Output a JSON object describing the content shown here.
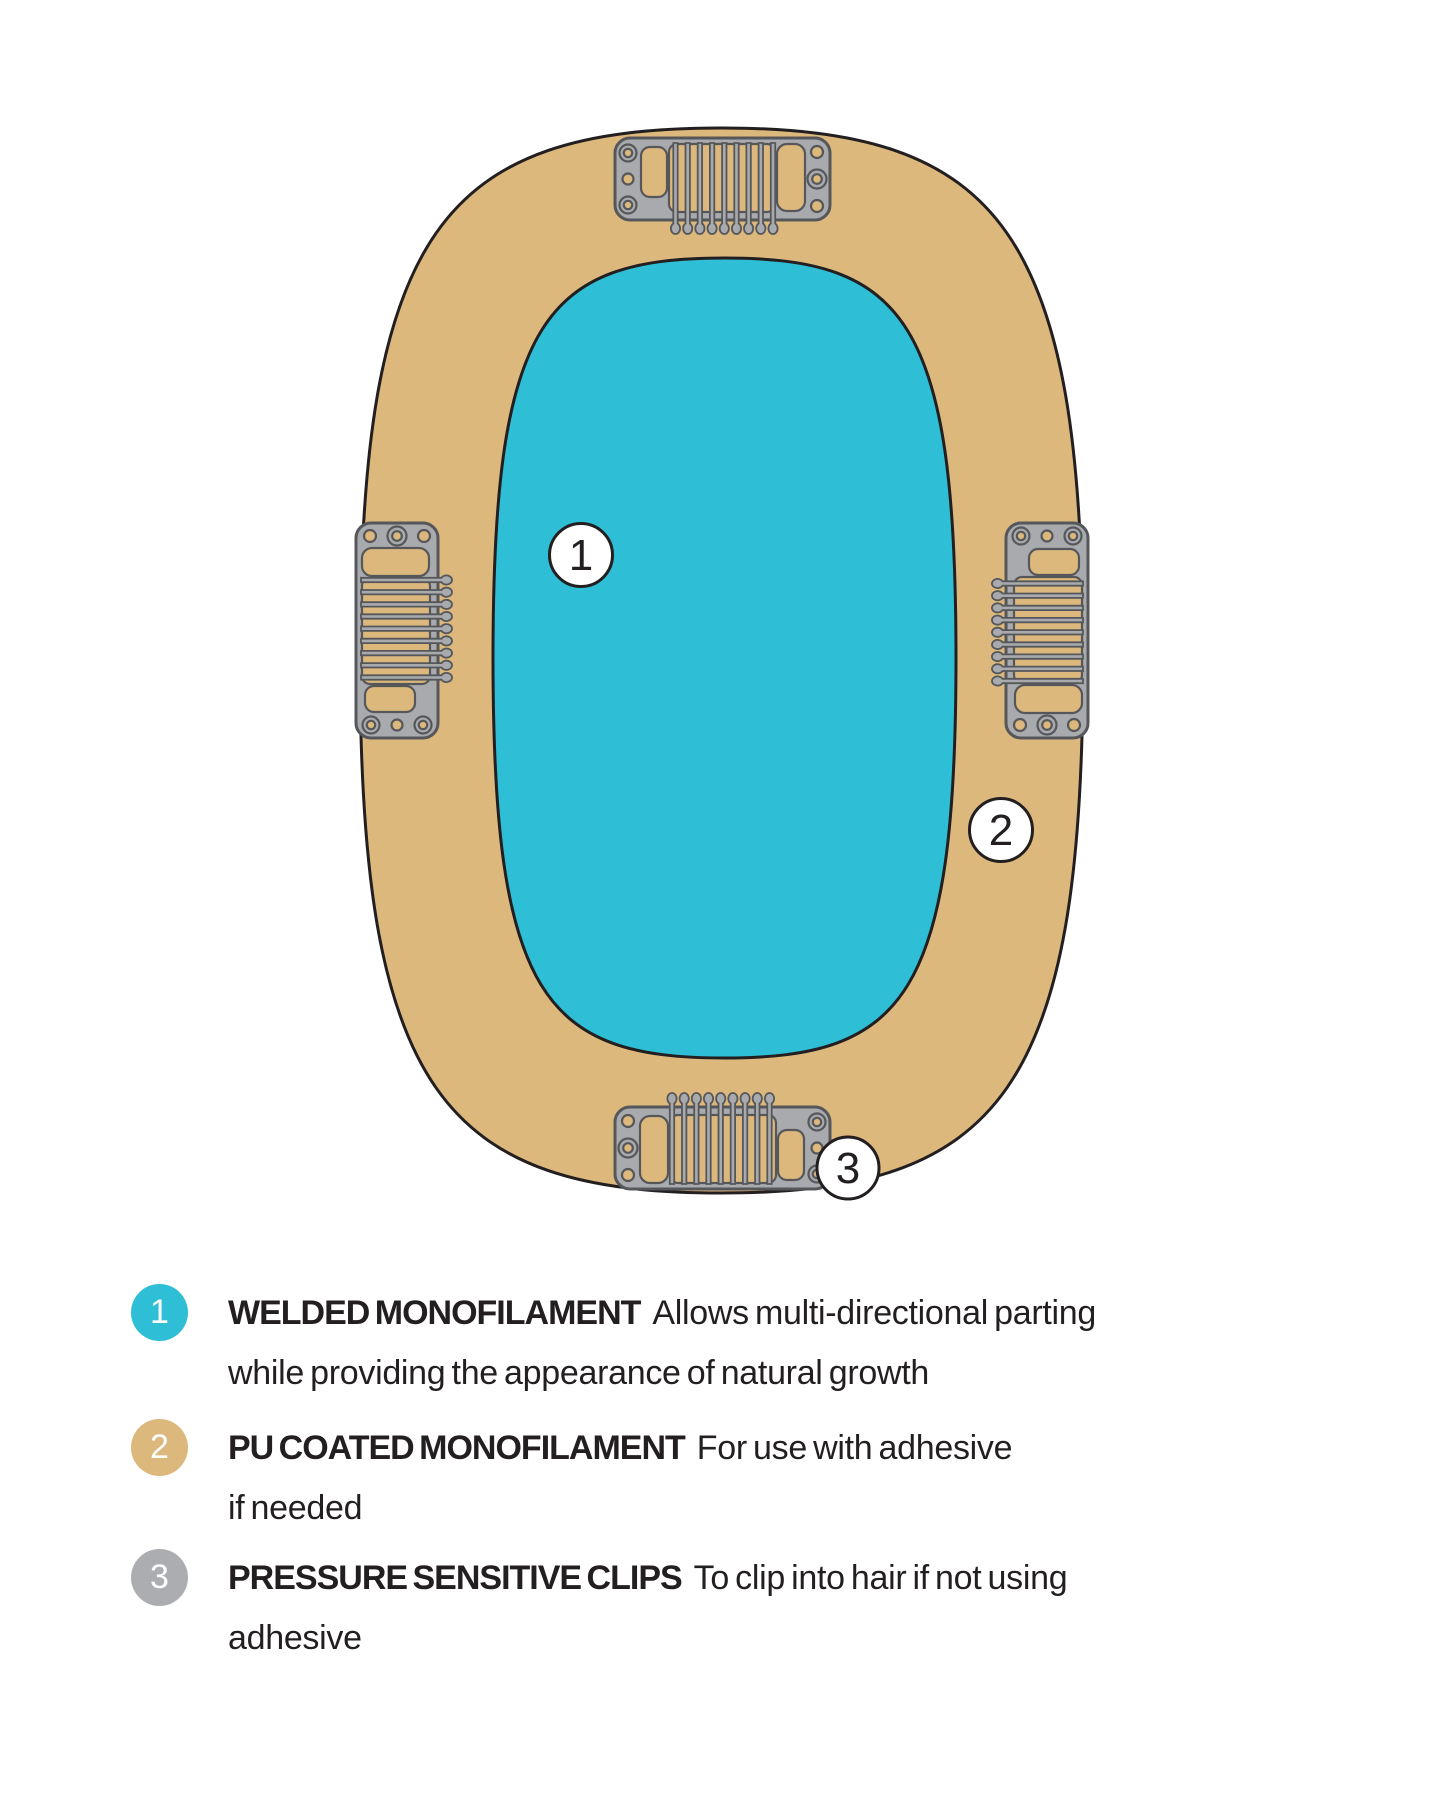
{
  "colors": {
    "teal": "#2EBED5",
    "tan": "#DDB87D",
    "clip-gray": "#A8AAAD",
    "clip-outline": "#55575A",
    "badge-gray": "#ABADB0",
    "outline": "#231F20",
    "text": "#231F20"
  },
  "diagram": {
    "description": "Hairpiece base construction diagram",
    "callouts": [
      {
        "number": "1"
      },
      {
        "number": "2"
      },
      {
        "number": "3"
      }
    ]
  },
  "legend": {
    "items": [
      {
        "number": "1",
        "term": "WELDED MONOFILAMENT",
        "desc_line1": "Allows multi-directional parting",
        "desc_line2": "while providing the appearance of natural growth",
        "badge_color": "#2EBED5"
      },
      {
        "number": "2",
        "term": "PU COATED MONOFILAMENT",
        "desc_line1": "For use with adhesive",
        "desc_line2": "if needed",
        "badge_color": "#DDB87D"
      },
      {
        "number": "3",
        "term": "PRESSURE SENSITIVE CLIPS",
        "desc_line1": "To clip into hair if not using",
        "desc_line2": "adhesive",
        "badge_color": "#ABADB0"
      }
    ]
  }
}
